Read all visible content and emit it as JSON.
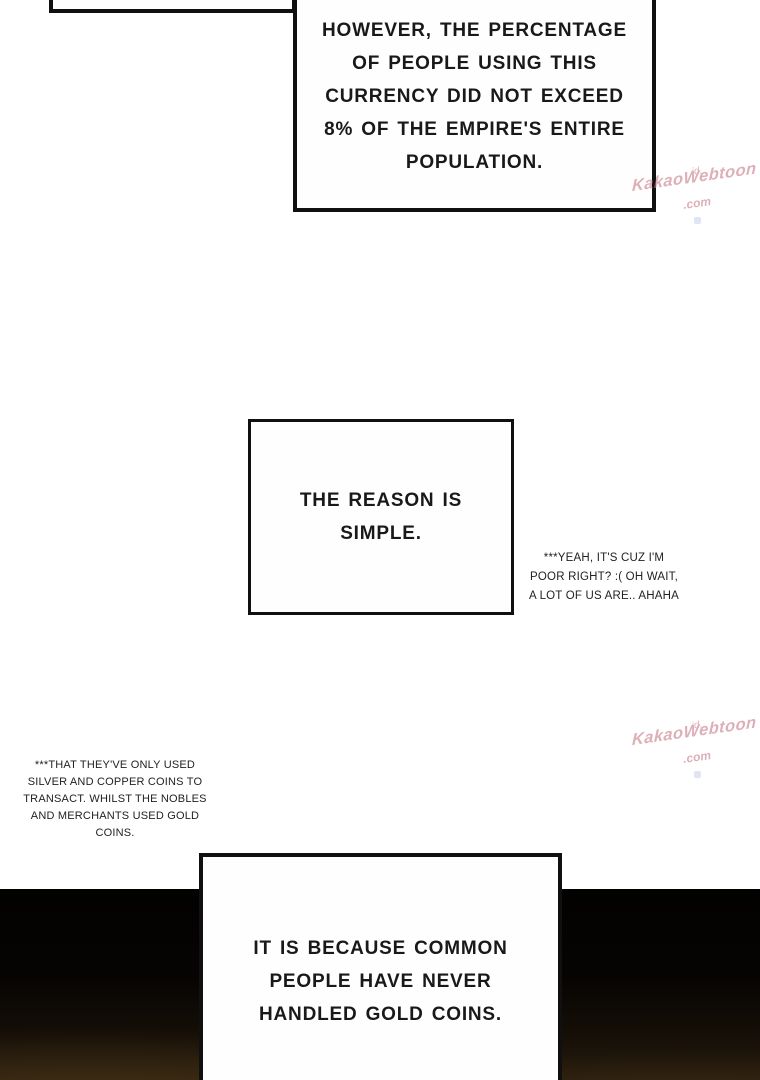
{
  "boxes": {
    "top": {
      "lines": [
        "HOWEVER, THE PERCENTAGE",
        "OF PEOPLE USING THIS",
        "CURRENCY DID NOT EXCEED",
        "8% OF THE EMPIRE'S ENTIRE",
        "POPULATION."
      ]
    },
    "middle": {
      "lines": [
        "THE REASON IS",
        "SIMPLE."
      ]
    },
    "bottom": {
      "lines": [
        "IT IS BECAUSE COMMON",
        "PEOPLE HAVE NEVER",
        "HANDLED GOLD COINS."
      ]
    }
  },
  "notes": {
    "right": {
      "lines": [
        "***YEAH, IT'S CUZ I'M",
        "POOR RIGHT? :( OH WAIT,",
        "A LOT OF US ARE.. AHAHA"
      ]
    },
    "left": {
      "lines": [
        "***THAT THEY'VE ONLY USED",
        "SILVER AND COPPER COINS TO",
        "TRANSACT. WHILST THE NOBLES",
        "AND MERCHANTS USED GOLD",
        "COINS."
      ]
    }
  },
  "watermark": {
    "prefix": "id.",
    "name": "KakaoWebtoon",
    "suffix": ".com",
    "color": "#c97f8d"
  },
  "colors": {
    "page_background": "#ffffff",
    "panel_fill": "#fefefe",
    "panel_border": "#101010",
    "ink": "#191919",
    "floor_black": "#020201",
    "floor_brown": "#281c0d",
    "watermark_dot": "#c7d2ea"
  }
}
